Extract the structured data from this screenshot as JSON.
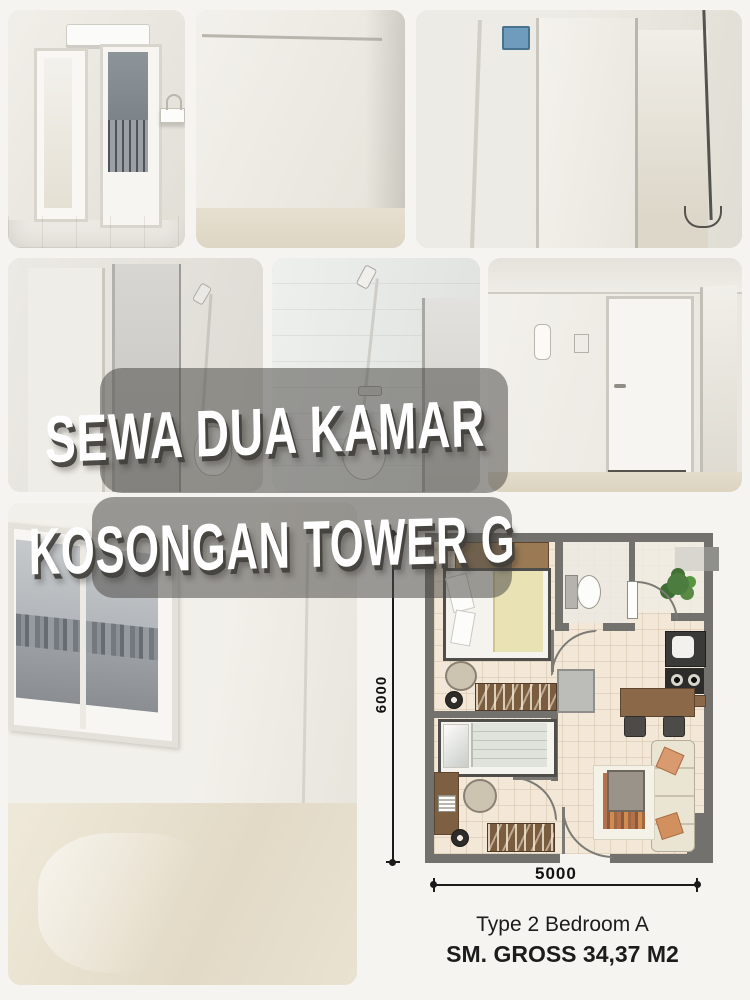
{
  "poster": {
    "title": {
      "line1": "SEWA DUA KAMAR",
      "line2": "KOSONGAN TOWER G"
    },
    "floorplan": {
      "height_dim_label": "6000",
      "width_dim_label": "5000",
      "type_label": "Type 2 Bedroom A",
      "gross_label": "SM. GROSS 34,37 M2"
    },
    "photos": [
      {
        "name": "hallway-with-ac-balcony-door-and-sink"
      },
      {
        "name": "empty-room-white-walls"
      },
      {
        "name": "corner-with-open-door-and-breaker-box"
      },
      {
        "name": "bathroom-door-shower-and-toilet"
      },
      {
        "name": "bathroom-shower-toilet-closeup"
      },
      {
        "name": "entrance-door-with-intercom"
      },
      {
        "name": "empty-room-window-city-view"
      }
    ],
    "colors": {
      "page_background": "#f6f4f1",
      "overlay_bar": "rgba(78,77,73,0.55)",
      "title_text": "#ffffff",
      "plan_wall": "#72716d",
      "plan_floor": "#f3e8d7",
      "plan_wood": "#8a6848",
      "plan_plant": "#4d7c3f",
      "caption_text": "#1c1c1c"
    }
  }
}
